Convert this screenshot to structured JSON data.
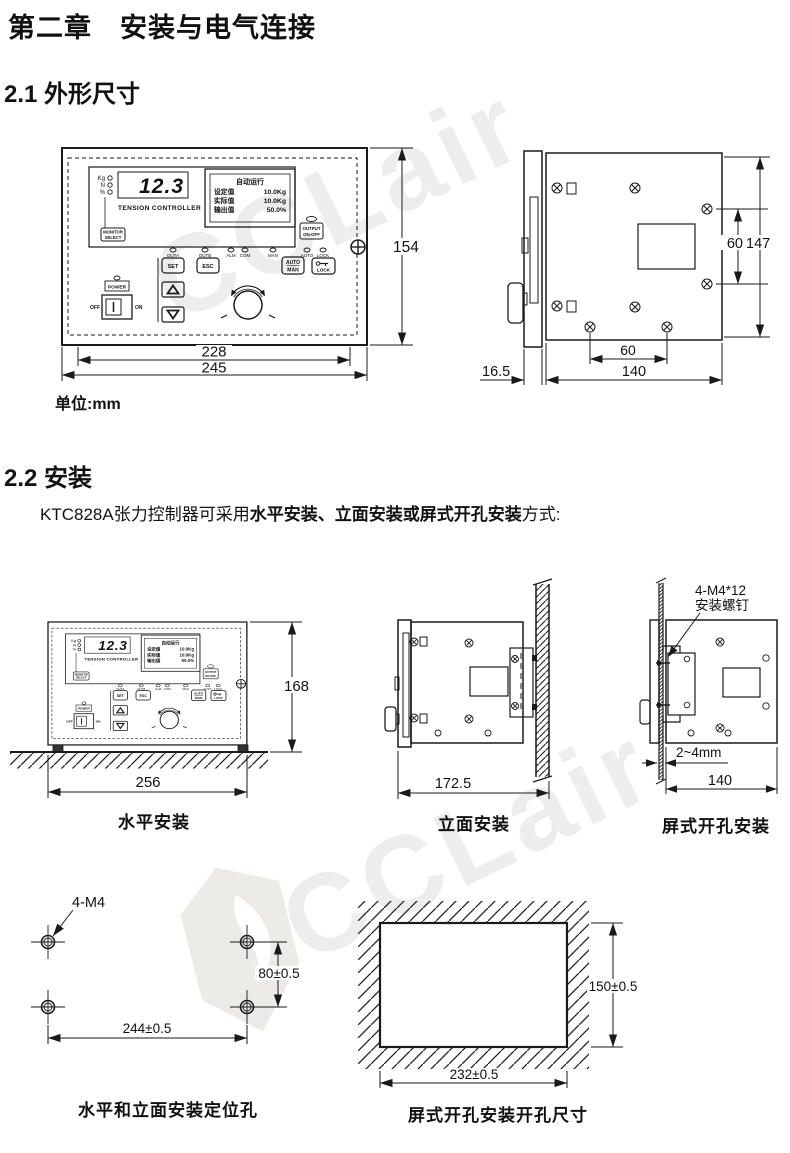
{
  "page": {
    "chapter_title": "第二章　安装与电气连接",
    "section1_title": "2.1 外形尺寸",
    "section2_title": "2.2 安装",
    "unit_note": "单位:mm",
    "intro_prefix": "KTC828A张力控制器可采用",
    "intro_bold": "水平安装、立面安装或屏式开孔安装",
    "intro_suffix": "方式:"
  },
  "panel": {
    "display_value": "12.3",
    "brand": "TENSION CONTROLLER",
    "unit_leds": [
      "Kg",
      "N",
      "%"
    ],
    "monitor_line1": "MONITOR",
    "monitor_line2": "SELECT",
    "lcd_title": "自动运行",
    "lcd_l1": "设定值",
    "lcd_v1": "10.0Kg",
    "lcd_l2": "实际值",
    "lcd_v2": "10.0Kg",
    "lcd_l3": "输出值",
    "lcd_v3": "50.0%",
    "output_line1": "OUTPUT",
    "output_line2": "ON-OFF",
    "led_row": [
      "OUTA",
      "OUTB",
      "ALM",
      "COM",
      "MAN",
      "AUTO",
      "LOCK"
    ],
    "set": "SET",
    "esc": "ESC",
    "auto": "AUTO",
    "man": "MAN",
    "lock": "LOCK",
    "power": "POWER",
    "off": "OFF",
    "on": "ON"
  },
  "front_view": {
    "dim_height": "154",
    "dim_width_inner": "228",
    "dim_width_outer": "245"
  },
  "side_view": {
    "dim_hole_v": "60",
    "dim_height": "147",
    "dim_hole_h": "60",
    "dim_depth": "16.5",
    "dim_width": "140"
  },
  "install": {
    "horizontal": {
      "caption": "水平安装",
      "dim_width": "256",
      "dim_height": "168"
    },
    "vertical": {
      "caption": "立面安装",
      "dim_depth": "172.5"
    },
    "panel_mount": {
      "caption": "屏式开孔安装",
      "screw_note1": "4-M4*12",
      "screw_note2": "安装螺钉",
      "gap": "2~4mm",
      "dim_width": "140"
    }
  },
  "holes": {
    "caption": "水平和立面安装定位孔",
    "label": "4-M4",
    "dim_v": "80±0.5",
    "dim_h": "244±0.5"
  },
  "cutout": {
    "caption": "屏式开孔安装开孔尺寸",
    "dim_v": "150±0.5",
    "dim_h": "232±0.5"
  },
  "watermark": {
    "text": "CCLair",
    "color": "#ededed"
  }
}
